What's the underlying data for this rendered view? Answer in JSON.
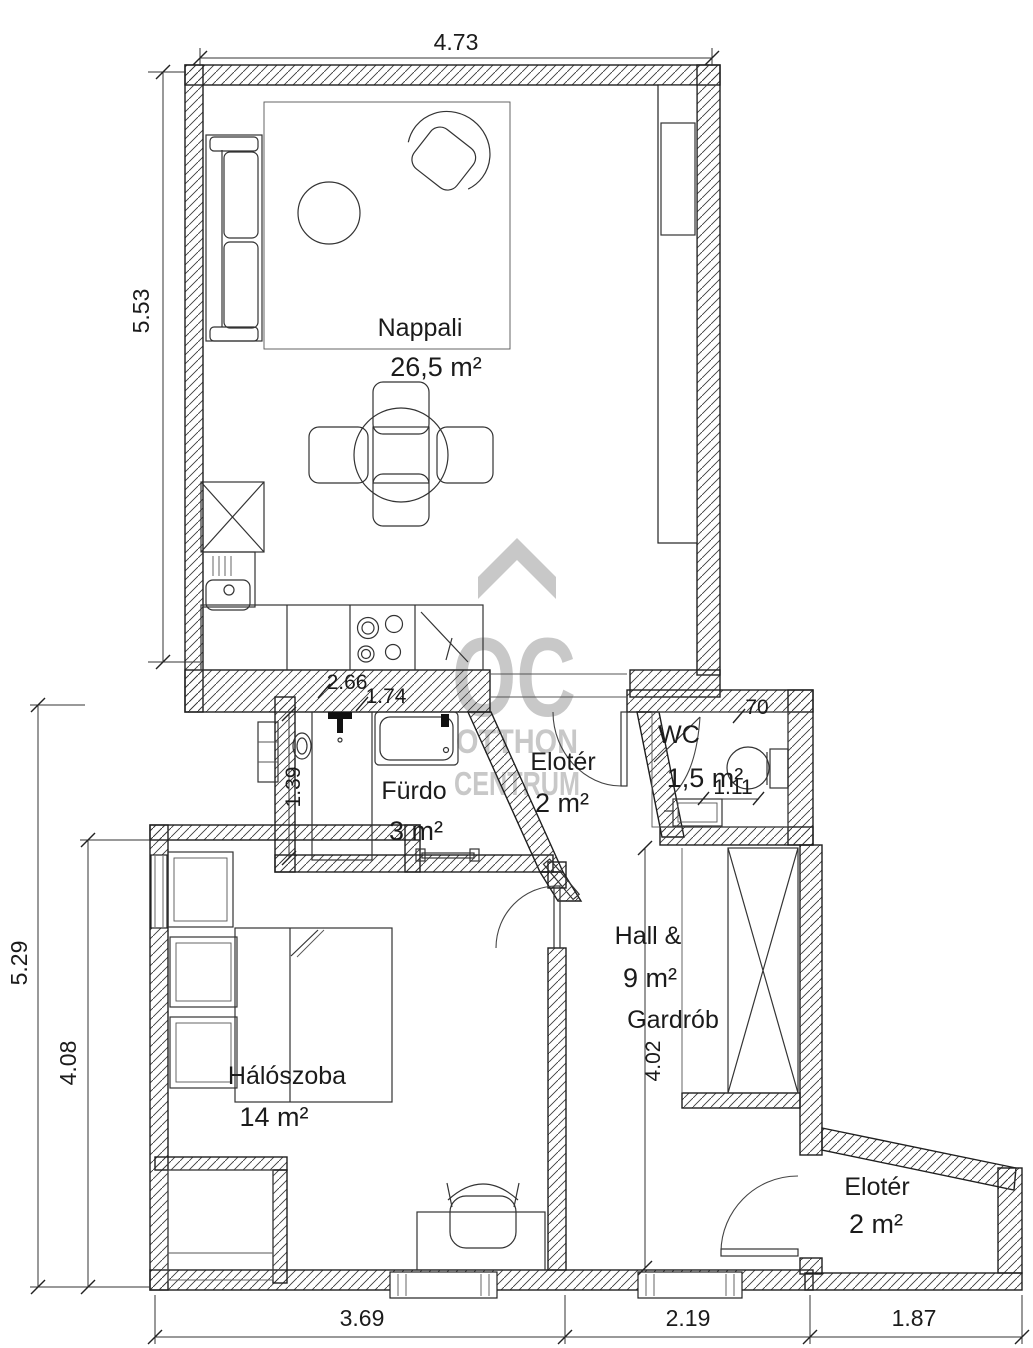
{
  "watermark": {
    "letters": "OC",
    "line1": "OTTHON",
    "line2": "CENTRUM"
  },
  "rooms": [
    {
      "name": "Nappali",
      "area": "26,5 m²"
    },
    {
      "name": "Fürdo",
      "area": "3 m²"
    },
    {
      "name": "Elotér",
      "area": "2 m²"
    },
    {
      "name": "WC",
      "area": "1,5 m²"
    },
    {
      "name": "Hall &",
      "area": "9 m²",
      "extra": "Gardrób"
    },
    {
      "name": "Hálószoba",
      "area": "14 m²"
    },
    {
      "name": "Elotér",
      "area": "2 m²"
    }
  ],
  "dimensions": {
    "top_width": "4.73",
    "living_height": "5.53",
    "lower_height": "5.29",
    "bedroom_height": "4.08",
    "kitchen_run": "2.66",
    "kitchen_inner": "1.74",
    "bath_depth": "1.39",
    "wc_door": "70",
    "wc_width": "1.11",
    "hall_height": "4.02",
    "bedroom_width": "3.69",
    "hall_width": "2.19",
    "entry_width": "1.87"
  }
}
